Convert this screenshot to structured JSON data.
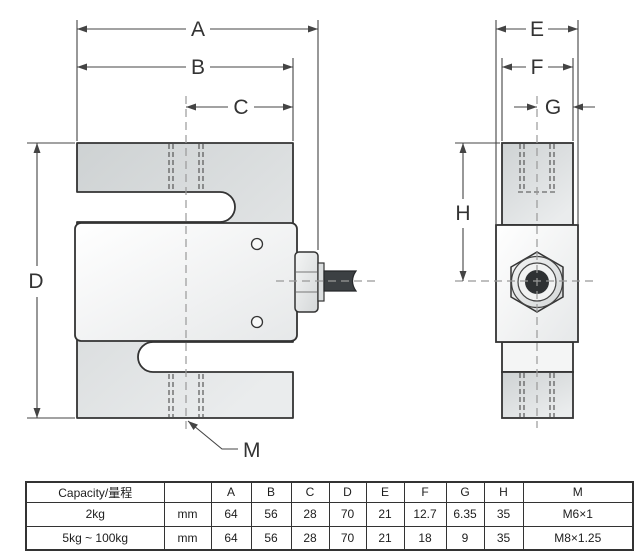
{
  "drawing": {
    "description_labels": {
      "A": "A",
      "B": "B",
      "C": "C",
      "D": "D",
      "E": "E",
      "F": "F",
      "G": "G",
      "H": "H",
      "M": "M"
    }
  },
  "table": {
    "header": [
      "Capacity/量程",
      "",
      "A",
      "B",
      "C",
      "D",
      "E",
      "F",
      "G",
      "H",
      "M"
    ],
    "rows": [
      [
        "2kg",
        "mm",
        "64",
        "56",
        "28",
        "70",
        "21",
        "12.7",
        "6.35",
        "35",
        "M6×1"
      ],
      [
        "5kg ~ 100kg",
        "mm",
        "64",
        "56",
        "28",
        "70",
        "21",
        "18",
        "9",
        "35",
        "M8×1.25"
      ]
    ]
  },
  "colors": {
    "outline": "#333333",
    "dimension_line": "#444444",
    "centerline": "#999999",
    "body_gray": "#d9dcdd",
    "cable": "#3c4043"
  }
}
